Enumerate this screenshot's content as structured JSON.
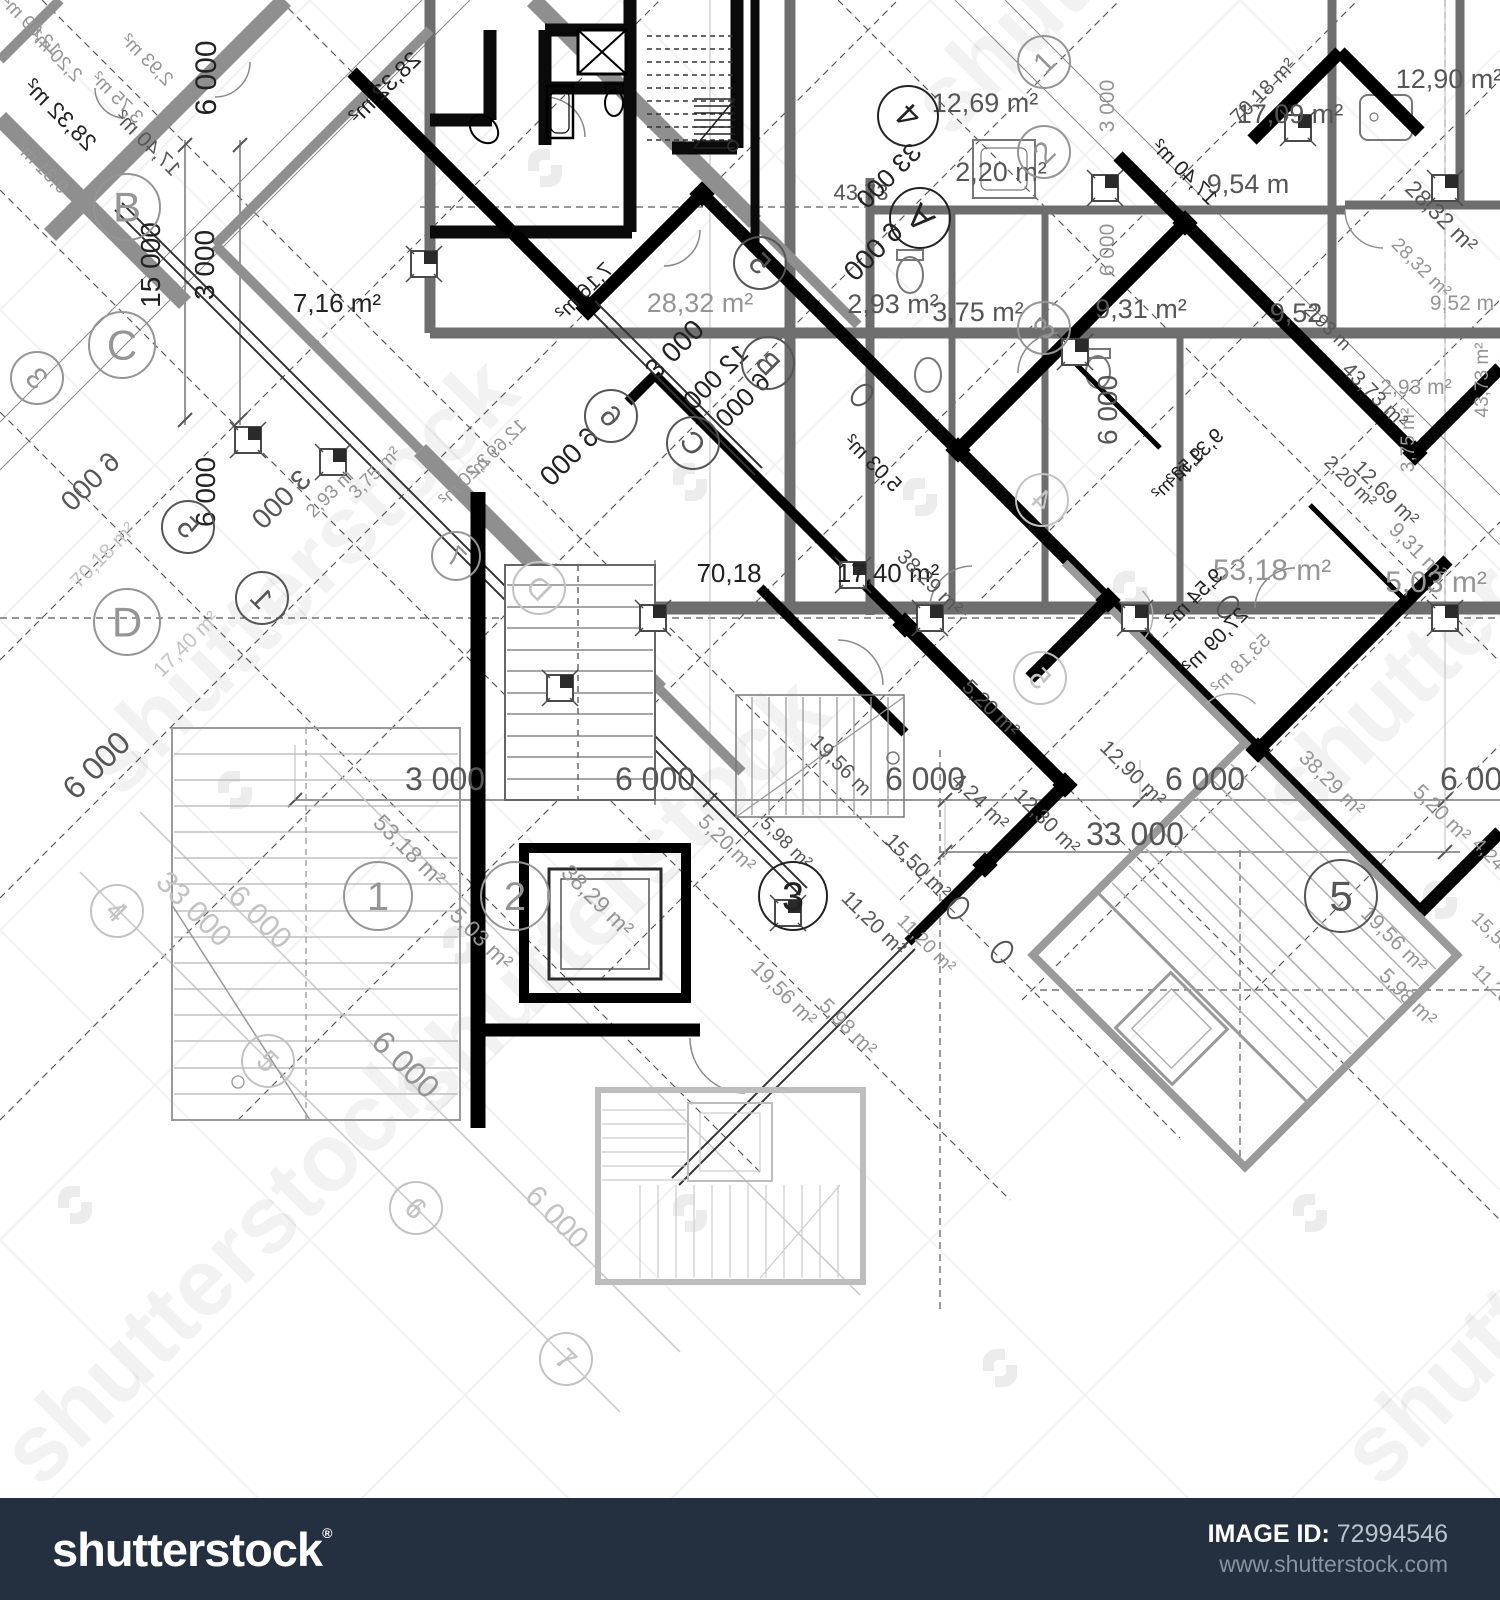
{
  "footer": {
    "logo_text": "shutterstock",
    "registered_mark": "®",
    "image_id_label": "IMAGE ID:",
    "image_id_value": "72994546",
    "site_url": "www.shutterstock.com",
    "bar_color": "#243040"
  },
  "watermark": {
    "brand_text": "shutterstock",
    "tiles": [
      {
        "t": "shutterstock",
        "x": 120,
        "y": 800
      },
      {
        "t": "shutterstock",
        "x": 430,
        "y": 1120
      },
      {
        "t": "shutterstock",
        "x": 1300,
        "y": 830
      },
      {
        "t": "shutterstock",
        "x": 950,
        "y": 140
      },
      {
        "t": "shutterstock",
        "x": 40,
        "y": 1490
      },
      {
        "t": "shutterstock",
        "x": 1380,
        "y": 1490
      }
    ]
  },
  "blueprint": {
    "labels": [
      {
        "t": "12,69 m²",
        "x": 985,
        "y": 112,
        "r": 0,
        "c": "d",
        "s": 27
      },
      {
        "t": "2,20 m²",
        "x": 1001,
        "y": 181,
        "r": 0,
        "c": "d",
        "s": 27
      },
      {
        "t": "2,93 m²",
        "x": 893,
        "y": 313,
        "r": 0,
        "c": "d",
        "s": 27
      },
      {
        "t": "3,75 m²",
        "x": 978,
        "y": 321,
        "r": 0,
        "c": "d",
        "s": 27
      },
      {
        "t": "9,31 m²",
        "x": 1141,
        "y": 318,
        "r": 0,
        "c": "d",
        "s": 27
      },
      {
        "t": "9,54 m",
        "x": 1248,
        "y": 193,
        "r": 0,
        "c": "d",
        "s": 27
      },
      {
        "t": "12,90 m²",
        "x": 1449,
        "y": 88,
        "r": 0,
        "c": "d",
        "s": 27
      },
      {
        "t": "17,09 m²",
        "x": 1290,
        "y": 123,
        "r": 0,
        "c": "d",
        "s": 27
      },
      {
        "t": "9,52",
        "x": 1296,
        "y": 322,
        "r": 0,
        "c": "d",
        "s": 27
      },
      {
        "t": "43,73",
        "x": 861,
        "y": 200,
        "r": 0,
        "c": "d",
        "s": 22
      },
      {
        "t": "28,32 m²",
        "x": 700,
        "y": 312,
        "r": 0,
        "c": "g",
        "s": 27
      },
      {
        "t": "7,16 m²",
        "x": 337,
        "y": 312,
        "r": 0,
        "c": "k",
        "s": 26
      },
      {
        "t": "70,18",
        "x": 729,
        "y": 582,
        "r": 0,
        "c": "k",
        "s": 26
      },
      {
        "t": "17,40 m²",
        "x": 888,
        "y": 582,
        "r": 0,
        "c": "k",
        "s": 26
      },
      {
        "t": "53,18 m²",
        "x": 1272,
        "y": 580,
        "r": 0,
        "c": "g",
        "s": 30
      },
      {
        "t": "5,03 m²",
        "x": 1436,
        "y": 592,
        "r": 0,
        "c": "g",
        "s": 30
      },
      {
        "t": "2,93 m²",
        "x": 1416,
        "y": 394,
        "r": 0,
        "c": "g",
        "s": 21
      },
      {
        "t": "9,52 m",
        "x": 1462,
        "y": 310,
        "r": 0,
        "c": "g",
        "s": 21
      },
      {
        "t": "3 000",
        "x": 445,
        "y": 790,
        "r": 0,
        "c": "d",
        "s": 32
      },
      {
        "t": "6 000",
        "x": 655,
        "y": 790,
        "r": 0,
        "c": "d",
        "s": 32
      },
      {
        "t": "6 000",
        "x": 925,
        "y": 790,
        "r": 0,
        "c": "d",
        "s": 32
      },
      {
        "t": "6 000",
        "x": 1205,
        "y": 790,
        "r": 0,
        "c": "d",
        "s": 32
      },
      {
        "t": "6 000",
        "x": 1480,
        "y": 790,
        "r": 0,
        "c": "d",
        "s": 32
      },
      {
        "t": "33 000",
        "x": 1135,
        "y": 845,
        "r": 0,
        "c": "d",
        "s": 32
      },
      {
        "t": "6 000",
        "x": 216,
        "y": 78,
        "r": -90,
        "c": "k",
        "s": 30
      },
      {
        "t": "15 000",
        "x": 160,
        "y": 265,
        "r": -90,
        "c": "k",
        "s": 28
      },
      {
        "t": "3 000",
        "x": 214,
        "y": 265,
        "r": -90,
        "c": "k",
        "s": 28
      },
      {
        "t": "3 000",
        "x": 1114,
        "y": 106,
        "r": -90,
        "c": "g",
        "s": 21
      },
      {
        "t": "6 000",
        "x": 1114,
        "y": 250,
        "r": -90,
        "c": "g",
        "s": 21
      },
      {
        "t": "6 000",
        "x": 1117,
        "y": 410,
        "r": -90,
        "c": "d",
        "s": 28
      },
      {
        "t": "6 000",
        "x": 215,
        "y": 492,
        "r": -90,
        "c": "k",
        "s": 28
      },
      {
        "t": "43,73 m²",
        "x": 1488,
        "y": 380,
        "r": -90,
        "c": "g",
        "s": 19
      },
      {
        "t": "3,75 m²",
        "x": 1414,
        "y": 440,
        "r": -90,
        "c": "g",
        "s": 19
      },
      {
        "t": "70,18 m²",
        "x": 1268,
        "y": 96,
        "r": -45,
        "c": "d",
        "s": 21
      },
      {
        "t": "53,18 m²",
        "x": 404,
        "y": 856,
        "r": 45,
        "c": "g",
        "s": 23
      },
      {
        "t": "5,03 m²",
        "x": 476,
        "y": 944,
        "r": 45,
        "c": "g",
        "s": 23
      },
      {
        "t": "38,29 m²",
        "x": 592,
        "y": 906,
        "r": 45,
        "c": "g",
        "s": 23
      },
      {
        "t": "6 000",
        "x": 398,
        "y": 1072,
        "r": 45,
        "c": "g",
        "s": 32
      },
      {
        "t": "5,20 m²",
        "x": 722,
        "y": 848,
        "r": 45,
        "c": "g",
        "s": 21
      },
      {
        "t": "19,56 m",
        "x": 836,
        "y": 770,
        "r": 45,
        "c": "d",
        "s": 21
      },
      {
        "t": "4,24 m²",
        "x": 975,
        "y": 806,
        "r": 45,
        "c": "d",
        "s": 21
      },
      {
        "t": "12,30 m²",
        "x": 1042,
        "y": 826,
        "r": 45,
        "c": "d",
        "s": 21
      },
      {
        "t": "12,90 m²",
        "x": 1128,
        "y": 778,
        "r": 45,
        "c": "d",
        "s": 21
      },
      {
        "t": "15,50 m²",
        "x": 913,
        "y": 871,
        "r": 45,
        "c": "d",
        "s": 21
      },
      {
        "t": "11,20 m²",
        "x": 869,
        "y": 928,
        "r": 45,
        "c": "d",
        "s": 21
      },
      {
        "t": "11,20 m²",
        "x": 922,
        "y": 948,
        "r": 45,
        "c": "g",
        "s": 19
      },
      {
        "t": "5,98 m²",
        "x": 782,
        "y": 847,
        "r": 45,
        "c": "d",
        "s": 19
      },
      {
        "t": "19,56 m²",
        "x": 779,
        "y": 998,
        "r": 45,
        "c": "g",
        "s": 21
      },
      {
        "t": "5,98 m²",
        "x": 843,
        "y": 1032,
        "r": 45,
        "c": "g",
        "s": 21
      },
      {
        "t": "5,20 m²",
        "x": 1437,
        "y": 818,
        "r": 45,
        "c": "g",
        "s": 21
      },
      {
        "t": "38,29 m²",
        "x": 1327,
        "y": 788,
        "r": 45,
        "c": "g",
        "s": 21
      },
      {
        "t": "19,56 m²",
        "x": 1389,
        "y": 944,
        "r": 45,
        "c": "g",
        "s": 21
      },
      {
        "t": "5,98 m²",
        "x": 1403,
        "y": 1002,
        "r": 45,
        "c": "g",
        "s": 21
      },
      {
        "t": "4,24 m²",
        "x": 1494,
        "y": 868,
        "r": 45,
        "c": "g",
        "s": 19
      },
      {
        "t": "15,50 m²",
        "x": 1497,
        "y": 946,
        "r": 45,
        "c": "g",
        "s": 19
      },
      {
        "t": "11,20 m²",
        "x": 1497,
        "y": 998,
        "r": 45,
        "c": "g",
        "s": 19
      },
      {
        "t": "33 000",
        "x": 187,
        "y": 916,
        "r": 45,
        "c": "l",
        "s": 30
      },
      {
        "t": "6 000",
        "x": 253,
        "y": 924,
        "r": 45,
        "c": "l",
        "s": 30
      },
      {
        "t": "6 000",
        "x": 550,
        "y": 1224,
        "r": 45,
        "c": "l",
        "s": 30
      },
      {
        "t": "12,69 m²",
        "x": 1381,
        "y": 498,
        "r": 45,
        "c": "d",
        "s": 21
      },
      {
        "t": "9,31 m²",
        "x": 1413,
        "y": 556,
        "r": 45,
        "c": "g",
        "s": 21
      },
      {
        "t": "43,73 m²",
        "x": 1370,
        "y": 400,
        "r": 45,
        "c": "d",
        "s": 21
      },
      {
        "t": "2,20 m²",
        "x": 1346,
        "y": 486,
        "r": 45,
        "c": "d",
        "s": 19
      },
      {
        "t": "28,32 m²",
        "x": 1436,
        "y": 222,
        "r": 45,
        "c": "d",
        "s": 23
      },
      {
        "t": "28,32 m²",
        "x": 1417,
        "y": 272,
        "r": 45,
        "c": "g",
        "s": 19
      },
      {
        "t": "2,93 m",
        "x": 1323,
        "y": 331,
        "r": 45,
        "c": "d",
        "s": 19
      },
      {
        "t": "17,40 m²",
        "x": 1180,
        "y": 177,
        "r": 45,
        "m": true,
        "c": "k",
        "s": 21
      },
      {
        "t": "28,32 m²",
        "x": 55,
        "y": 120,
        "r": 45,
        "m": true,
        "c": "k",
        "s": 23
      },
      {
        "t": "28,32 m²",
        "x": 390,
        "y": 93,
        "r": -45,
        "m": true,
        "c": "k",
        "s": 23
      },
      {
        "t": "12,69 m²",
        "x": 27,
        "y": 30,
        "r": 45,
        "m": true,
        "c": "g",
        "s": 19
      },
      {
        "t": "2,20 m²",
        "x": 52,
        "y": 60,
        "r": 45,
        "m": true,
        "c": "g",
        "s": 19
      },
      {
        "t": "2,93 m²",
        "x": 143,
        "y": 64,
        "r": 45,
        "m": true,
        "c": "g",
        "s": 19
      },
      {
        "t": "3,75 m²",
        "x": 113,
        "y": 102,
        "r": 45,
        "m": true,
        "c": "g",
        "s": 19
      },
      {
        "t": "9,31 m²",
        "x": 38,
        "y": 172,
        "r": 45,
        "m": true,
        "c": "g",
        "s": 19
      },
      {
        "t": "17,40 m²",
        "x": 143,
        "y": 148,
        "r": 45,
        "m": true,
        "c": "d",
        "s": 21
      },
      {
        "t": "7,16 m²",
        "x": 589,
        "y": 296,
        "r": -45,
        "m": true,
        "c": "k",
        "s": 21
      },
      {
        "t": "3 000",
        "x": 681,
        "y": 356,
        "r": -45,
        "c": "k",
        "s": 28
      },
      {
        "t": "12 000",
        "x": 722,
        "y": 383,
        "r": -45,
        "m": true,
        "c": "k",
        "s": 26
      },
      {
        "t": "6 000",
        "x": 749,
        "y": 406,
        "r": -45,
        "m": true,
        "c": "k",
        "s": 26
      },
      {
        "t": "6 000",
        "x": 576,
        "y": 463,
        "r": -45,
        "m": true,
        "c": "k",
        "s": 28
      },
      {
        "t": "12,69 m²",
        "x": 501,
        "y": 453,
        "r": -45,
        "m": true,
        "c": "g",
        "s": 19
      },
      {
        "t": "2,20 m²",
        "x": 469,
        "y": 484,
        "r": -45,
        "m": true,
        "c": "g",
        "s": 19
      },
      {
        "t": "6 000",
        "x": 97,
        "y": 488,
        "r": -45,
        "m": true,
        "c": "d",
        "s": 28
      },
      {
        "t": "3 000",
        "x": 288,
        "y": 506,
        "r": -45,
        "m": true,
        "c": "d",
        "s": 28
      },
      {
        "t": "2,93 m",
        "x": 334,
        "y": 498,
        "r": -45,
        "c": "g",
        "s": 19
      },
      {
        "t": "70,18 m²",
        "x": 108,
        "y": 560,
        "r": -45,
        "c": "l",
        "s": 21
      },
      {
        "t": "17,40 m²",
        "x": 191,
        "y": 649,
        "r": -45,
        "c": "l",
        "s": 21
      },
      {
        "t": "3,75 m²",
        "x": 379,
        "y": 477,
        "r": -45,
        "c": "g",
        "s": 19
      },
      {
        "t": "6 000",
        "x": 104,
        "y": 773,
        "r": -45,
        "c": "d",
        "s": 32
      },
      {
        "t": "33 000",
        "x": 895,
        "y": 182,
        "r": -45,
        "m": true,
        "c": "k",
        "s": 26
      },
      {
        "t": "6 000",
        "x": 880,
        "y": 258,
        "r": -45,
        "m": true,
        "c": "k",
        "s": 28
      },
      {
        "t": "5,03 m²",
        "x": 868,
        "y": 468,
        "r": 45,
        "m": true,
        "c": "k",
        "s": 21
      },
      {
        "t": "38,29 m²",
        "x": 925,
        "y": 587,
        "r": 45,
        "c": "d",
        "s": 21
      },
      {
        "t": "5,20 m²",
        "x": 986,
        "y": 713,
        "r": 45,
        "c": "d",
        "s": 21
      },
      {
        "t": "9,31 m²",
        "x": 1200,
        "y": 462,
        "r": -45,
        "m": true,
        "c": "k",
        "s": 21
      },
      {
        "t": "9,54 m²",
        "x": 1199,
        "y": 602,
        "r": -45,
        "m": true,
        "c": "k",
        "s": 21
      },
      {
        "t": "27,09 m²",
        "x": 1220,
        "y": 645,
        "r": -45,
        "m": true,
        "c": "k",
        "s": 21
      },
      {
        "t": "53,18 m²",
        "x": 1245,
        "y": 668,
        "r": -45,
        "m": true,
        "c": "g",
        "s": 19
      },
      {
        "t": "9,52 m²",
        "x": 1182,
        "y": 478,
        "r": -45,
        "m": true,
        "c": "k",
        "s": 19
      }
    ],
    "grid_markers": [
      {
        "t": "B",
        "x": 127,
        "y": 207,
        "r": 0,
        "c": "g",
        "rad": 33,
        "s": 42
      },
      {
        "t": "C",
        "x": 122,
        "y": 345,
        "r": 0,
        "c": "g",
        "rad": 33,
        "s": 42
      },
      {
        "t": "D",
        "x": 127,
        "y": 622,
        "r": 0,
        "c": "g",
        "rad": 33,
        "s": 42
      },
      {
        "t": "3",
        "x": 37,
        "y": 378,
        "r": 45,
        "m": true,
        "c": "g",
        "rad": 26,
        "s": 30
      },
      {
        "t": "A",
        "x": 920,
        "y": 218,
        "r": -135,
        "c": "k",
        "rad": 30,
        "s": 34
      },
      {
        "t": "4",
        "x": 908,
        "y": 116,
        "r": -135,
        "c": "k",
        "rad": 30,
        "s": 34
      },
      {
        "t": "1",
        "x": 1044,
        "y": 62,
        "r": -45,
        "c": "g",
        "rad": 26,
        "s": 30
      },
      {
        "t": "2",
        "x": 1044,
        "y": 152,
        "r": -45,
        "c": "g",
        "rad": 26,
        "s": 30
      },
      {
        "t": "3",
        "x": 1044,
        "y": 328,
        "r": -45,
        "c": "g",
        "rad": 26,
        "s": 30
      },
      {
        "t": "1",
        "x": 378,
        "y": 896,
        "r": 0,
        "c": "g",
        "rad": 34,
        "s": 40
      },
      {
        "t": "2",
        "x": 515,
        "y": 896,
        "r": 0,
        "c": "g",
        "rad": 34,
        "s": 40
      },
      {
        "t": "3",
        "x": 793,
        "y": 896,
        "r": 0,
        "c": "k",
        "rad": 34,
        "s": 40
      },
      {
        "t": "5",
        "x": 1341,
        "y": 896,
        "r": 0,
        "c": "d",
        "rad": 36,
        "s": 42
      },
      {
        "t": "5",
        "x": 188,
        "y": 527,
        "r": 45,
        "m": true,
        "c": "d",
        "rad": 26,
        "s": 30
      },
      {
        "t": "1",
        "x": 262,
        "y": 598,
        "r": 45,
        "m": true,
        "c": "d",
        "rad": 26,
        "s": 30
      },
      {
        "t": "6",
        "x": 611,
        "y": 416,
        "r": 45,
        "m": true,
        "c": "d",
        "rad": 26,
        "s": 30
      },
      {
        "t": "C",
        "x": 693,
        "y": 443,
        "r": 45,
        "m": true,
        "c": "d",
        "rad": 26,
        "s": 30
      },
      {
        "t": "B",
        "x": 768,
        "y": 363,
        "r": 45,
        "m": true,
        "c": "d",
        "rad": 26,
        "s": 30
      },
      {
        "t": "5",
        "x": 760,
        "y": 263,
        "r": 45,
        "m": true,
        "c": "d",
        "rad": 26,
        "s": 30
      },
      {
        "t": "4",
        "x": 117,
        "y": 911,
        "r": 45,
        "c": "l",
        "rad": 26,
        "s": 30
      },
      {
        "t": "5",
        "x": 268,
        "y": 1061,
        "r": 45,
        "c": "l",
        "rad": 26,
        "s": 30
      },
      {
        "t": "6",
        "x": 416,
        "y": 1208,
        "r": 45,
        "c": "l",
        "rad": 26,
        "s": 30
      },
      {
        "t": "7",
        "x": 566,
        "y": 1359,
        "r": 45,
        "c": "l",
        "rad": 26,
        "s": 30
      },
      {
        "t": "4",
        "x": 1042,
        "y": 500,
        "r": 45,
        "m": true,
        "c": "l",
        "rad": 26,
        "s": 30
      },
      {
        "t": "5",
        "x": 1040,
        "y": 678,
        "r": 45,
        "m": true,
        "c": "l",
        "rad": 26,
        "s": 30
      },
      {
        "t": "7",
        "x": 456,
        "y": 556,
        "r": 45,
        "m": true,
        "c": "g",
        "rad": 24,
        "s": 28
      },
      {
        "t": "D",
        "x": 539,
        "y": 588,
        "r": 45,
        "m": true,
        "c": "l",
        "rad": 26,
        "s": 30
      }
    ]
  }
}
